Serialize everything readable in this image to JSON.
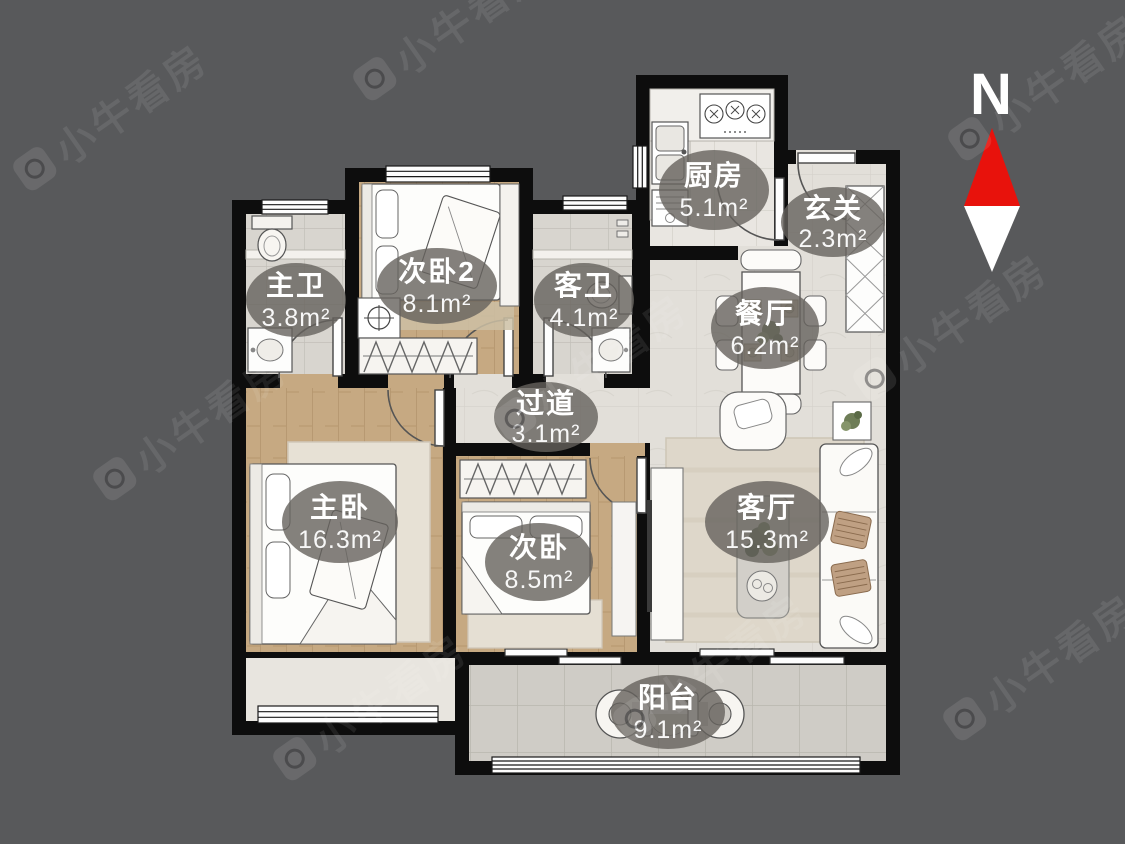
{
  "canvas": {
    "background": "#58595b",
    "wall_color": "#0d0d0d"
  },
  "compass": {
    "label": "N",
    "north_color": "#e8120c",
    "south_color": "#ffffff"
  },
  "watermark": {
    "text": "小牛看房"
  },
  "rooms": [
    {
      "id": "master-bath",
      "name": "主卫",
      "area": "3.8m²"
    },
    {
      "id": "bedroom2",
      "name": "次卧2",
      "area": "8.1m²"
    },
    {
      "id": "guest-bath",
      "name": "客卫",
      "area": "4.1m²"
    },
    {
      "id": "kitchen",
      "name": "厨房",
      "area": "5.1m²"
    },
    {
      "id": "entry",
      "name": "玄关",
      "area": "2.3m²"
    },
    {
      "id": "dining",
      "name": "餐厅",
      "area": "6.2m²"
    },
    {
      "id": "hallway",
      "name": "过道",
      "area": "3.1m²"
    },
    {
      "id": "master-bedroom",
      "name": "主卧",
      "area": "16.3m²"
    },
    {
      "id": "bedroom",
      "name": "次卧",
      "area": "8.5m²"
    },
    {
      "id": "living",
      "name": "客厅",
      "area": "15.3m²"
    },
    {
      "id": "balcony",
      "name": "阳台",
      "area": "9.1m²"
    }
  ]
}
